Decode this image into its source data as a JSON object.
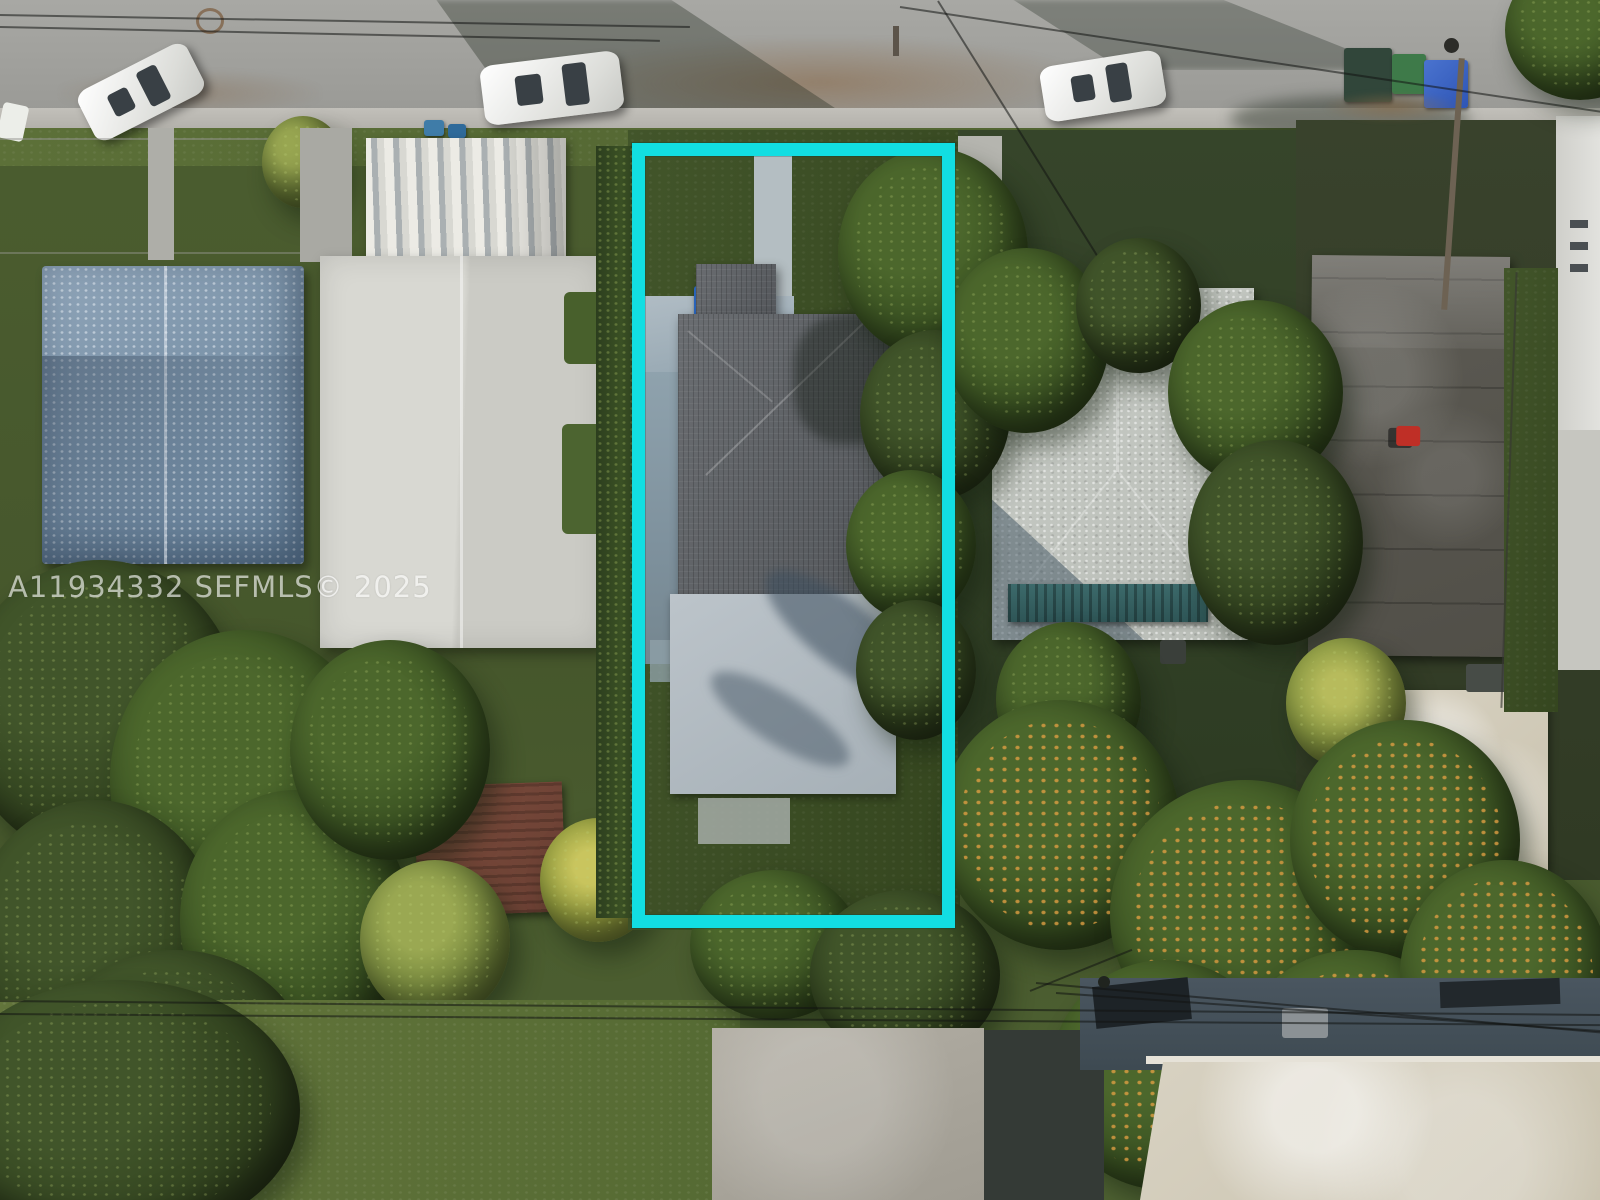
{
  "watermark": {
    "text": "A11934332  SEFMLS© 2025",
    "color": "#ffffff",
    "opacity": 0.62
  },
  "highlight": {
    "label": "subject-property-boundary",
    "color": "#12dee2",
    "left": 632,
    "top": 143,
    "width": 323,
    "height": 785,
    "thickness_px": 13
  },
  "scene": {
    "type": "aerial-drone-photo",
    "setting": "residential-neighborhood-overhead-view",
    "street_position": "top-horizontal",
    "cars": [
      {
        "color": "white",
        "location": "street-top-left"
      },
      {
        "color": "white",
        "location": "street-top-center"
      },
      {
        "color": "white",
        "location": "street-top-right"
      }
    ],
    "subject_lot": {
      "outlined": true,
      "features": [
        "dark-gray-shingle-roof-house",
        "flat-gray-roof-addition",
        "concrete-driveway",
        "front-walkway",
        "blue-recycle-bins",
        "green-bin",
        "hedge-left-boundary",
        "overhanging-trees-right"
      ]
    },
    "neighbors": {
      "far_left": "building-with-plastic-tarp-covered-roof",
      "left": "white-flat-roof-building-with-corrugated-metal-carport",
      "right": "light-gray-hip-roof-house-with-teal-awning",
      "far_right": "dark-weathered-flat-roof-building-and-pale-garage",
      "bottom_right": "large-flat-roof-building-under-power-lines"
    },
    "vegetation": [
      "large-tree-canopy-left",
      "orange-flowering-trees-bottom-right",
      "yellow-palm",
      "open-lawn-bottom-left"
    ]
  },
  "palette": {
    "street": "#a0a09c",
    "sidewalk": "#bab8b2",
    "grass": "#55683a",
    "canopy_dark": "#33481f",
    "canopy_orange": "#c08840",
    "shingle_roof": "#63666a",
    "white_roof": "#d6d6d0",
    "tarp_roof": "#8096ac",
    "dark_roof": "#57554f",
    "pale_concrete": "#d2cbbb",
    "teal_awning": "#366263",
    "accent": "#12dee2"
  }
}
